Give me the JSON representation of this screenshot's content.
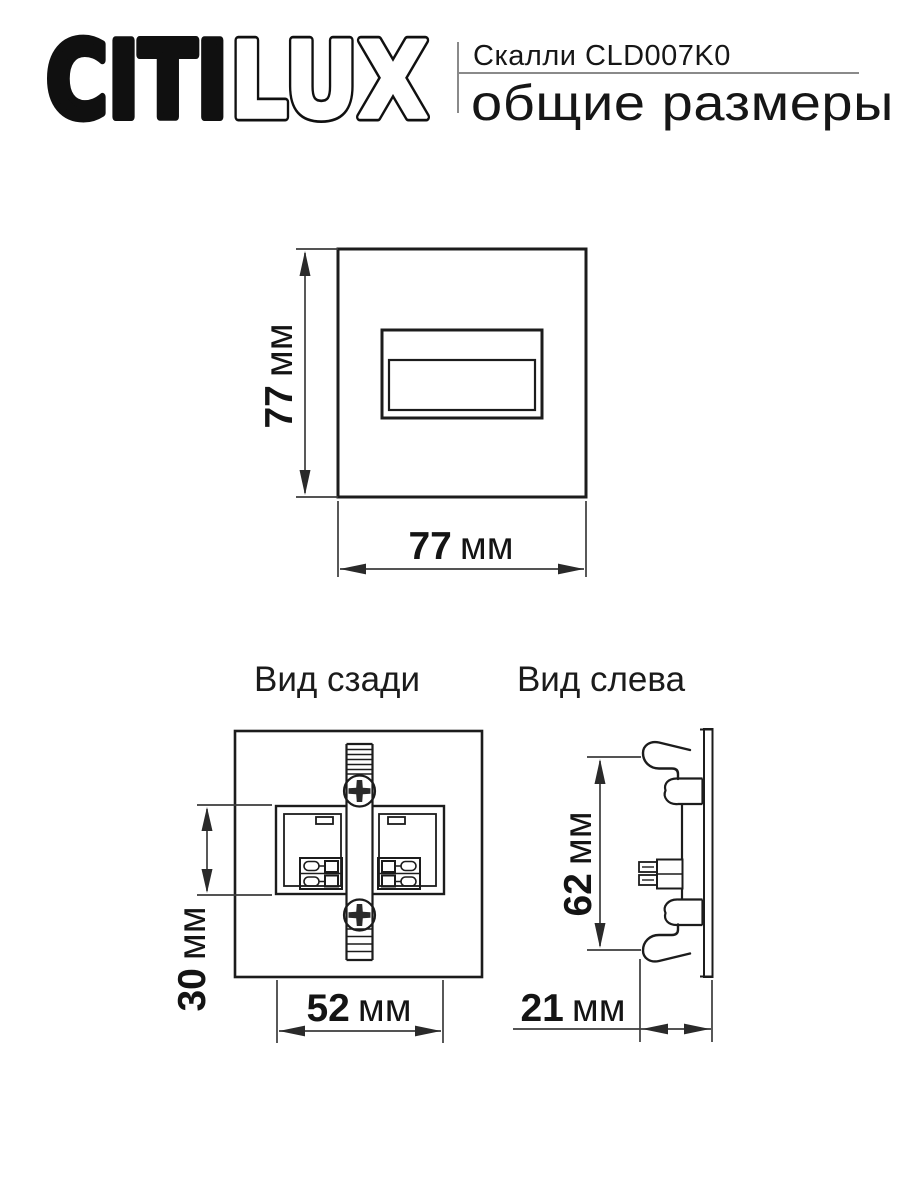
{
  "header": {
    "logo_solid": "CITI",
    "logo_outline": "LUX",
    "product": "Скалли CLD007K0",
    "subtitle": "общие размеры"
  },
  "views": {
    "front": {
      "height_value": "77",
      "height_unit": "мм",
      "width_value": "77",
      "width_unit": "мм"
    },
    "rear": {
      "title": "Вид сзади",
      "height_value": "30",
      "height_unit": "мм",
      "width_value": "52",
      "width_unit": "мм"
    },
    "left": {
      "title": "Вид слева",
      "height_value": "62",
      "height_unit": "мм",
      "depth_value": "21",
      "depth_unit": "мм"
    }
  },
  "colors": {
    "line": "#1c1c1c",
    "dimension_line": "#3c3c3c",
    "rule": "#8a8a8a",
    "text": "#161616",
    "background": "#ffffff"
  }
}
